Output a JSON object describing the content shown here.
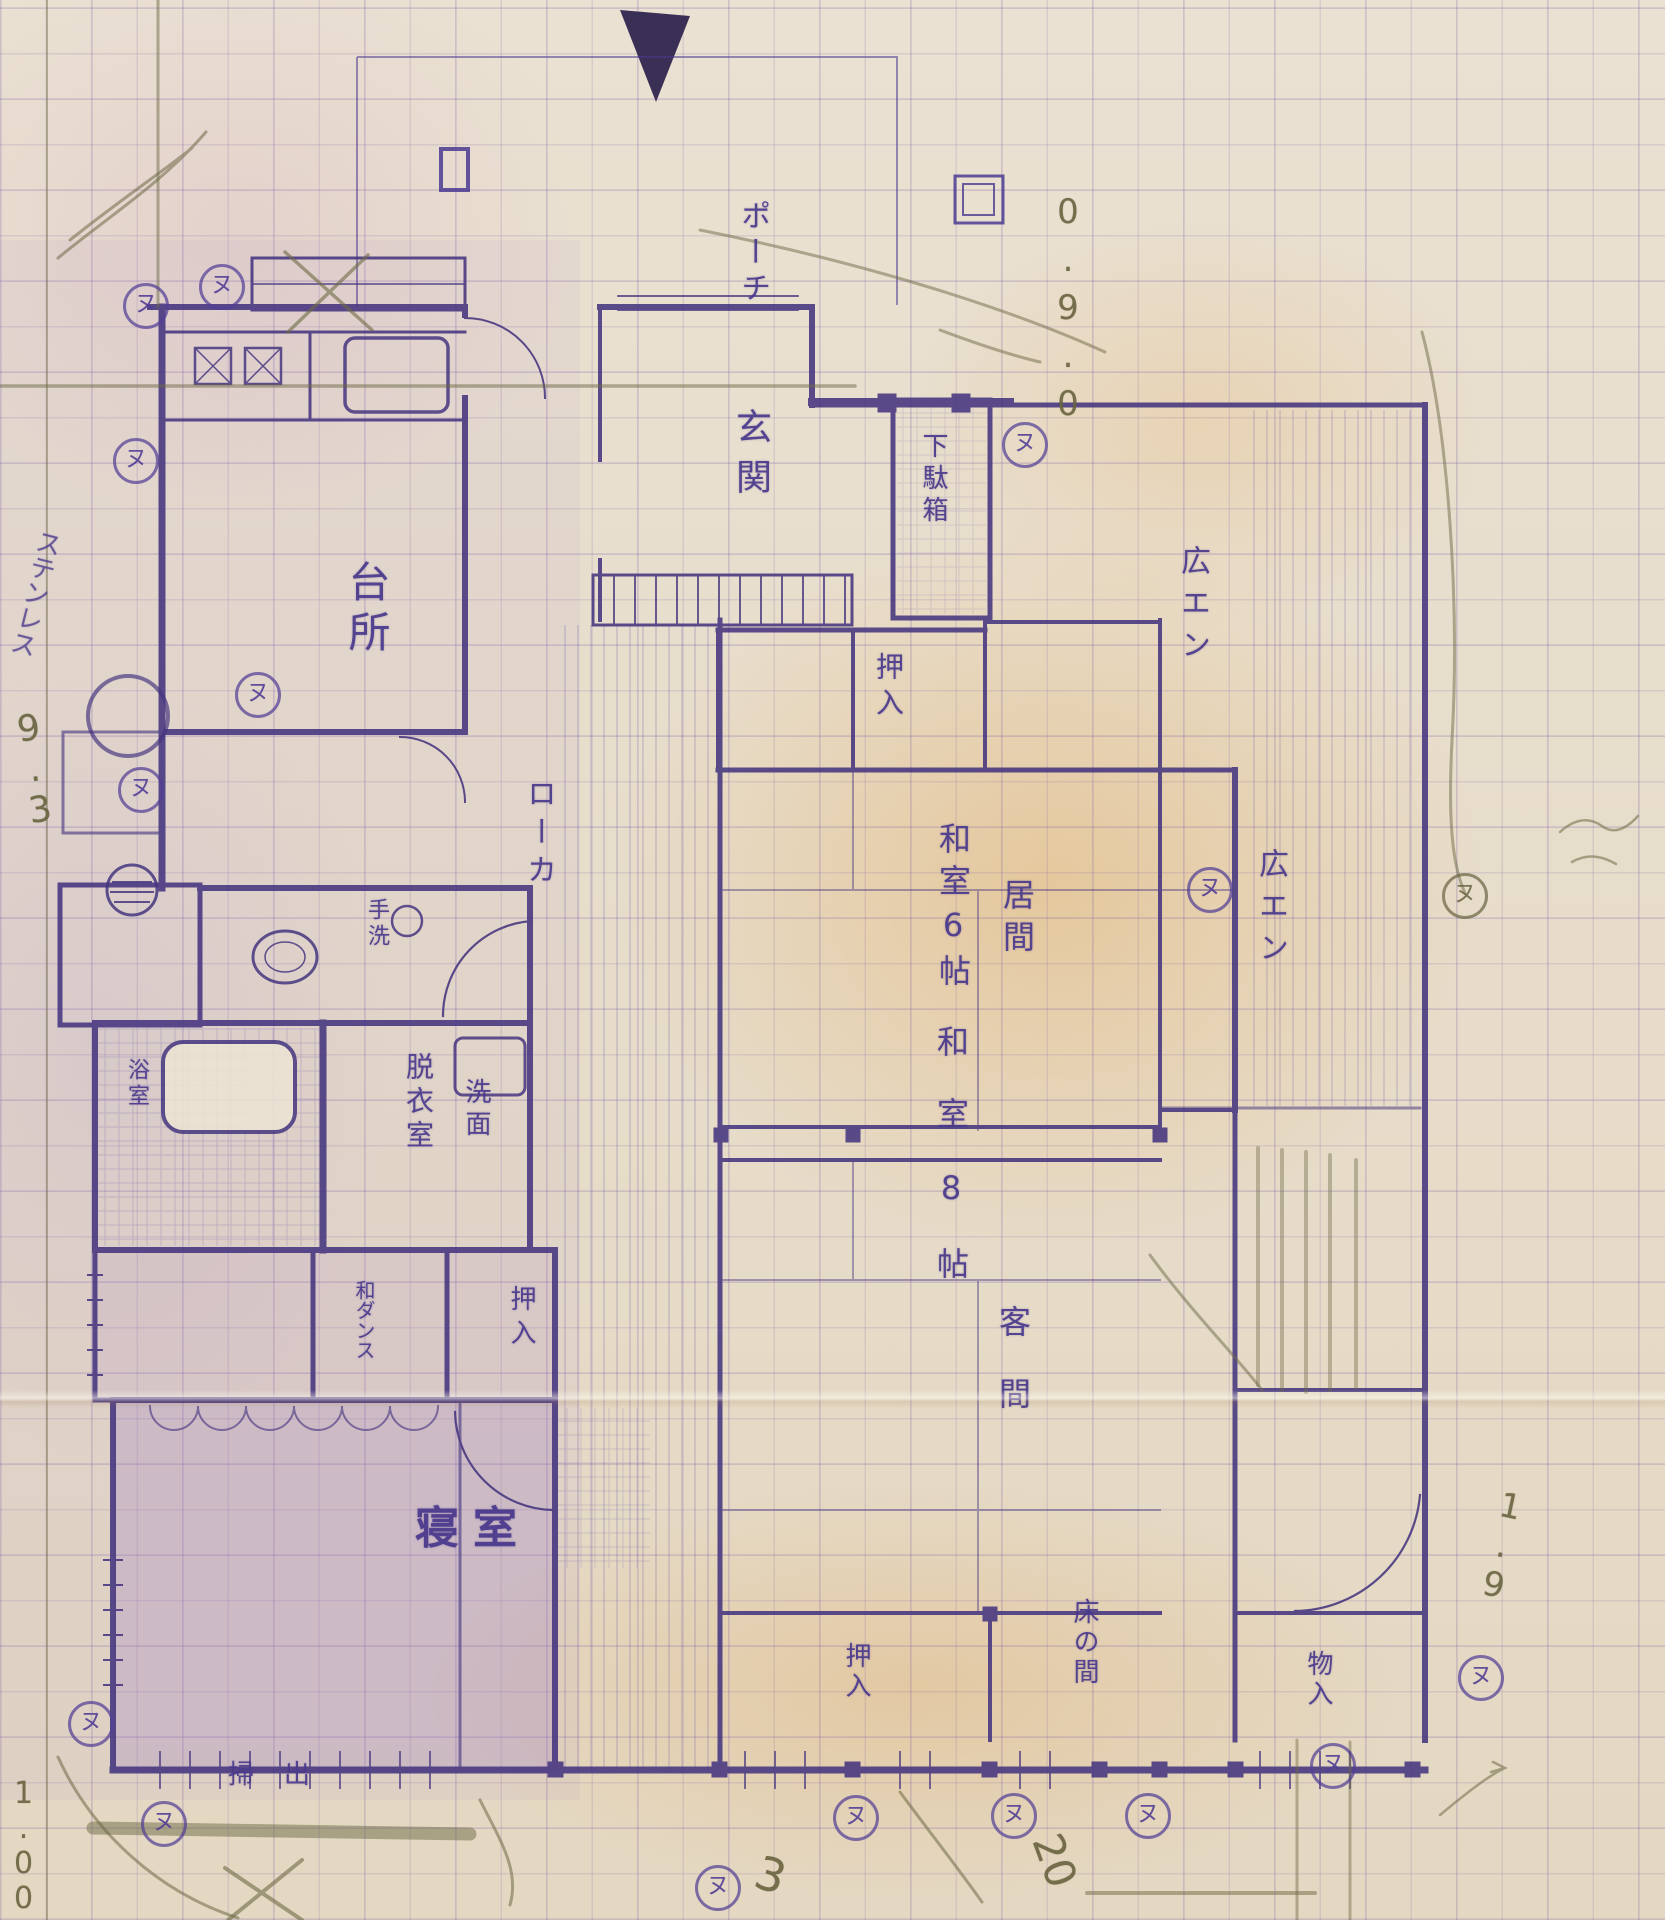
{
  "rooms": {
    "kitchen": {
      "label": "台所"
    },
    "porch": {
      "label": "ポーチ"
    },
    "entrance": {
      "label": "玄関"
    },
    "shoe_cabinet": {
      "label": "下駄箱"
    },
    "closet_north": {
      "label": "押入"
    },
    "tatami6": {
      "label": "和室6帖"
    },
    "living": {
      "label": "居間"
    },
    "tatami8": {
      "label": "和室8帖"
    },
    "guest": {
      "label": "客間"
    },
    "veranda_north": {
      "label": "広エン"
    },
    "veranda_east": {
      "label": "広エン"
    },
    "corridor": {
      "label": "ローカ"
    },
    "dressing": {
      "label": "脱衣室"
    },
    "washstand": {
      "label": "洗面"
    },
    "hand_wash": {
      "label": "手洗"
    },
    "bath": {
      "label": "浴室"
    },
    "wardrobe": {
      "label": "和ダンス"
    },
    "closet_mid": {
      "label": "押入"
    },
    "bedroom": {
      "label": "寝室"
    },
    "tokonoma": {
      "label": "床の間"
    },
    "closet_tokonoma": {
      "label": "押入"
    },
    "storage": {
      "label": "物入"
    },
    "sweep_window": {
      "label": "掃出"
    }
  },
  "annotations": {
    "circled_mark": "ヌ",
    "ink_note": "ステンレス",
    "pencil_top_right": "0.9.0",
    "pencil_left": "9.3",
    "pencil_bottom_left": "1.00",
    "pencil_right": "1.9",
    "pencil_num_20": "20",
    "pencil_num_3": "3"
  }
}
